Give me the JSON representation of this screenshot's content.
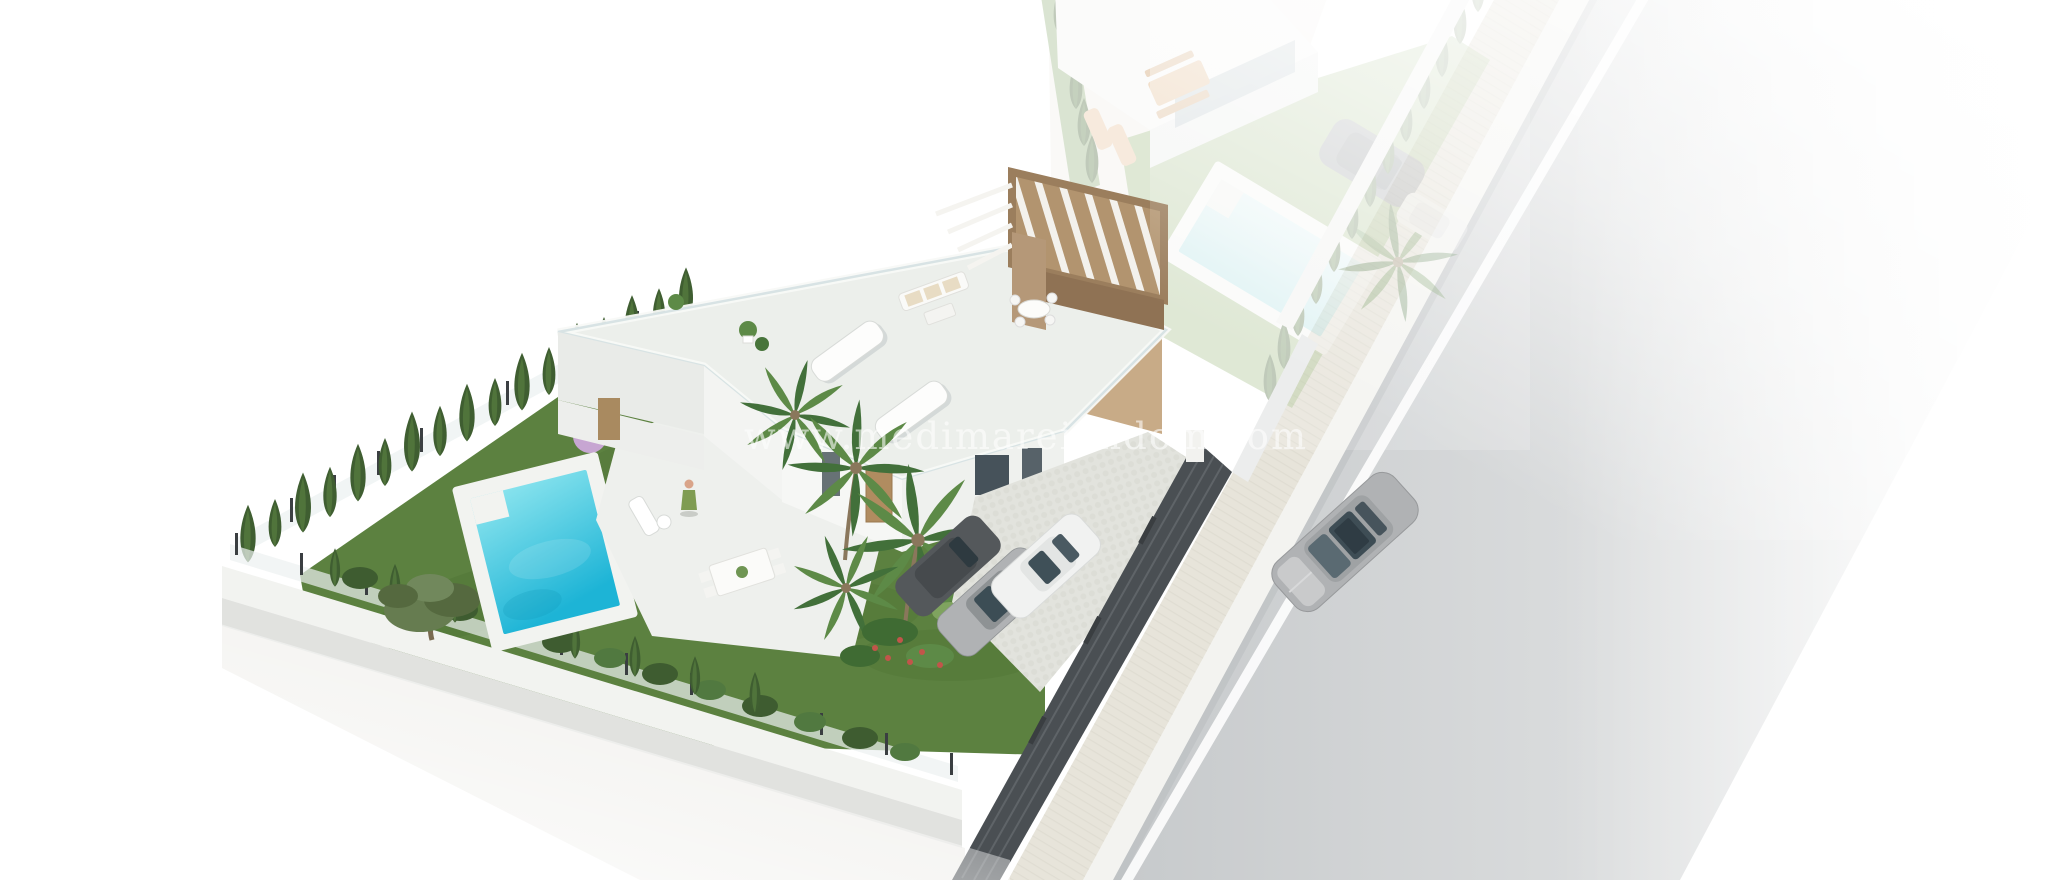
{
  "watermark": {
    "text": "www.medimareiendom.com"
  },
  "scene": {
    "type": "3d-architectural-render",
    "view": "aerial-isometric-villa-development",
    "main_plot": {
      "villa": "modern white two-storey villa with rooftop terrace and brown pergola",
      "pool": "private turquoise pool with white deck and entry step",
      "garden": [
        "lawn",
        "cypress hedge boundary",
        "palm trees",
        "olive tree",
        "lilac tree",
        "flower bushes"
      ],
      "driveway": "cobbled driveway with parked cars",
      "parked_cars": [
        "dark grey car",
        "silver car",
        "white car"
      ],
      "street_fence": "dark slatted fence with white gate pillar",
      "terrace": [
        "sun loungers",
        "outdoor sofa set",
        "dining table",
        "potted plants",
        "person standing"
      ],
      "perimeter": "white wall with glass fence and hedge"
    },
    "neighbor_plot": {
      "faded": true,
      "villa": "second villa with glazed facade and patio",
      "pool": "pool with white deck",
      "furniture": [
        "wooden dining set",
        "sun loungers"
      ],
      "parked_cars": [
        "dark car",
        "white car"
      ],
      "hedge": "cypress hedge along boundary fence"
    },
    "street": {
      "road": "asphalt road with white lane line",
      "sidewalk": "paved sidewalk with white kerb",
      "moving_car": "silver sedan driving on road"
    }
  },
  "colors": {
    "background": "#ffffff",
    "lawn": "#5c8140",
    "lawn_dark": "#4b6f33",
    "pool_shallow": "#8fe6ef",
    "pool_deep": "#1db4d6",
    "pool_deck": "#f2f3f0",
    "cypress": "#3f5e31",
    "palm": "#4f7d3b",
    "pergola": "#b2946f",
    "pergola_shadow": "#8f7254",
    "house_white": "#f6f7f5",
    "house_shadow": "#e4e6e4",
    "fence_dark": "#4a4f53",
    "road": "#c6c9cb",
    "road_light": "#eeefef",
    "lane_line": "#ffffff",
    "sidewalk": "#e7e4da",
    "curb": "#f3f3f0",
    "driveway": "#e2e3dd",
    "car_silver": "#b0b2b4",
    "car_white": "#f1f2f1",
    "car_dark": "#54585b",
    "car_window": "#3c4d55",
    "watermark": "#ffffff"
  }
}
